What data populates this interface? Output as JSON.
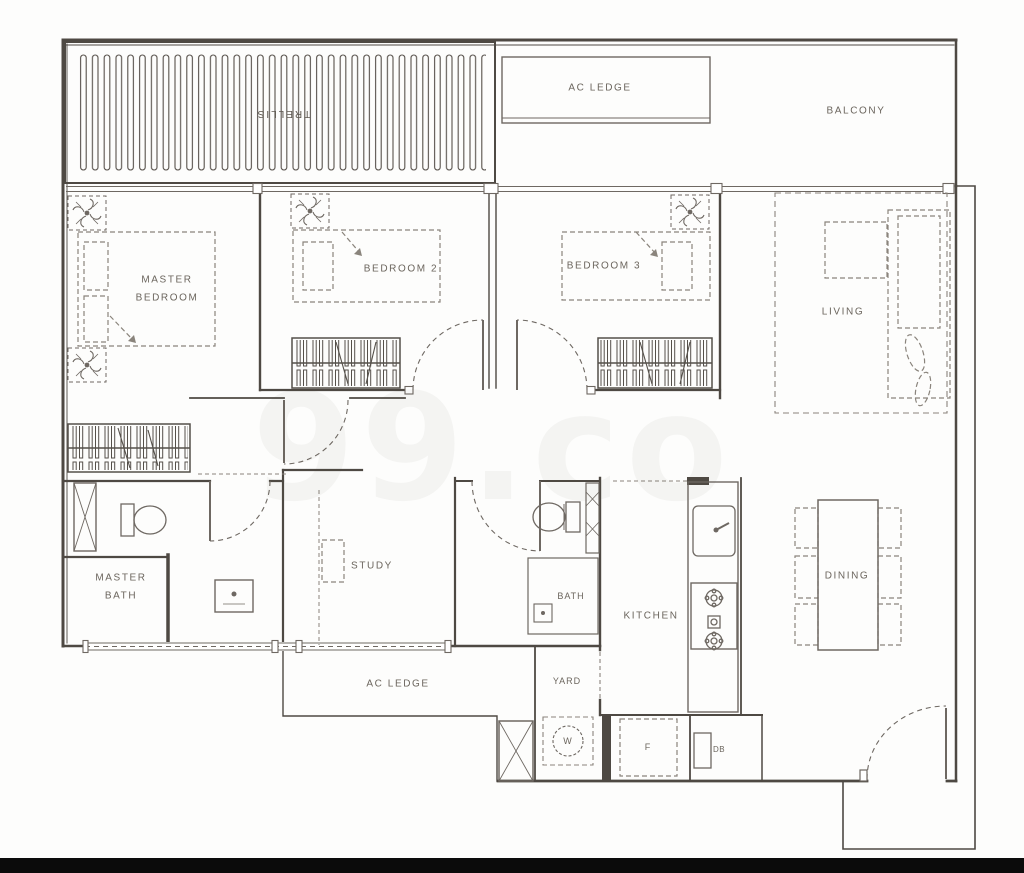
{
  "page": {
    "watermark": "99.co",
    "background": "#fdfdfc",
    "bottom_bar_color": "#0b0b0b",
    "wall_line_color": "#4e4943",
    "fixture_line_color": "#6e6862",
    "furniture_line_color": "#8a847c",
    "label_color": "#6b655d"
  },
  "labels": [
    {
      "id": "trellis",
      "text": "TRELLIS"
    },
    {
      "id": "ac-ledge-top",
      "text": "AC LEDGE"
    },
    {
      "id": "balcony",
      "text": "BALCONY"
    },
    {
      "id": "master-bedroom",
      "text": "MASTER\nBEDROOM"
    },
    {
      "id": "bedroom-2",
      "text": "BEDROOM 2"
    },
    {
      "id": "bedroom-3",
      "text": "BEDROOM 3"
    },
    {
      "id": "living",
      "text": "LIVING"
    },
    {
      "id": "master-bath",
      "text": "MASTER\nBATH"
    },
    {
      "id": "study",
      "text": "STUDY"
    },
    {
      "id": "bath",
      "text": "BATH"
    },
    {
      "id": "kitchen",
      "text": "KITCHEN"
    },
    {
      "id": "dining",
      "text": "DINING"
    },
    {
      "id": "ac-ledge-bottom",
      "text": "AC LEDGE"
    },
    {
      "id": "yard",
      "text": "YARD"
    },
    {
      "id": "washer",
      "text": "W"
    },
    {
      "id": "fridge",
      "text": "F"
    },
    {
      "id": "distribution-board",
      "text": "DB"
    }
  ]
}
